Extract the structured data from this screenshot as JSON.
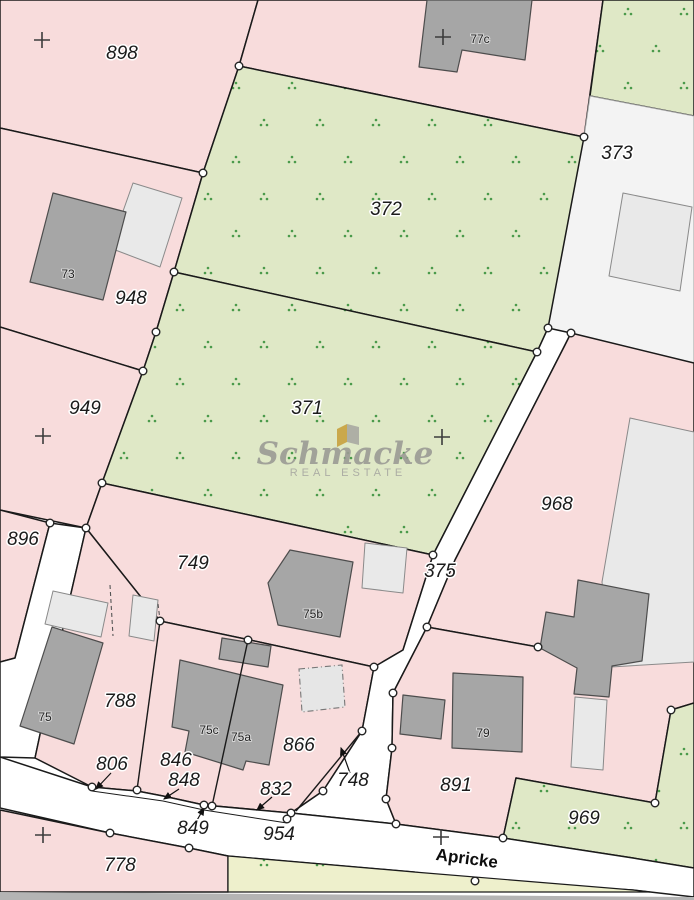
{
  "map": {
    "street_name": "Apricke",
    "watermark": {
      "brand": "Schmacke",
      "tagline": "REAL ESTATE"
    },
    "parcel_labels": {
      "p898": "898",
      "p948": "948",
      "p949": "949",
      "p896": "896",
      "p372": "372",
      "p371": "371",
      "p373": "373",
      "p968": "968",
      "p749": "749",
      "p375": "375",
      "p788": "788",
      "p806": "806",
      "p846": "846",
      "p848": "848",
      "p866": "866",
      "p832": "832",
      "p748": "748",
      "p849": "849",
      "p954": "954",
      "p891": "891",
      "p969": "969",
      "p778": "778"
    },
    "building_labels": {
      "b73": "73",
      "b75": "75",
      "b75a": "75a",
      "b75b": "75b",
      "b75c": "75c",
      "b77c": "77c",
      "b79": "79"
    },
    "colors": {
      "c-pink": "#f8dcdc",
      "c-green": "#dfe8c6",
      "c-yellow": "#eef0cc",
      "c-open": "#f3f3f3",
      "c-road": "#ffffff",
      "c-line": "#1a1a1a",
      "c-bdark": "#a6a6a6",
      "c-blight": "#e9e9e9",
      "c-dots": "#4a9a4a",
      "c-wm": "#9b9b95",
      "c-gold": "#c8a13e",
      "c-gray-strip": "#b4b4b4"
    }
  }
}
